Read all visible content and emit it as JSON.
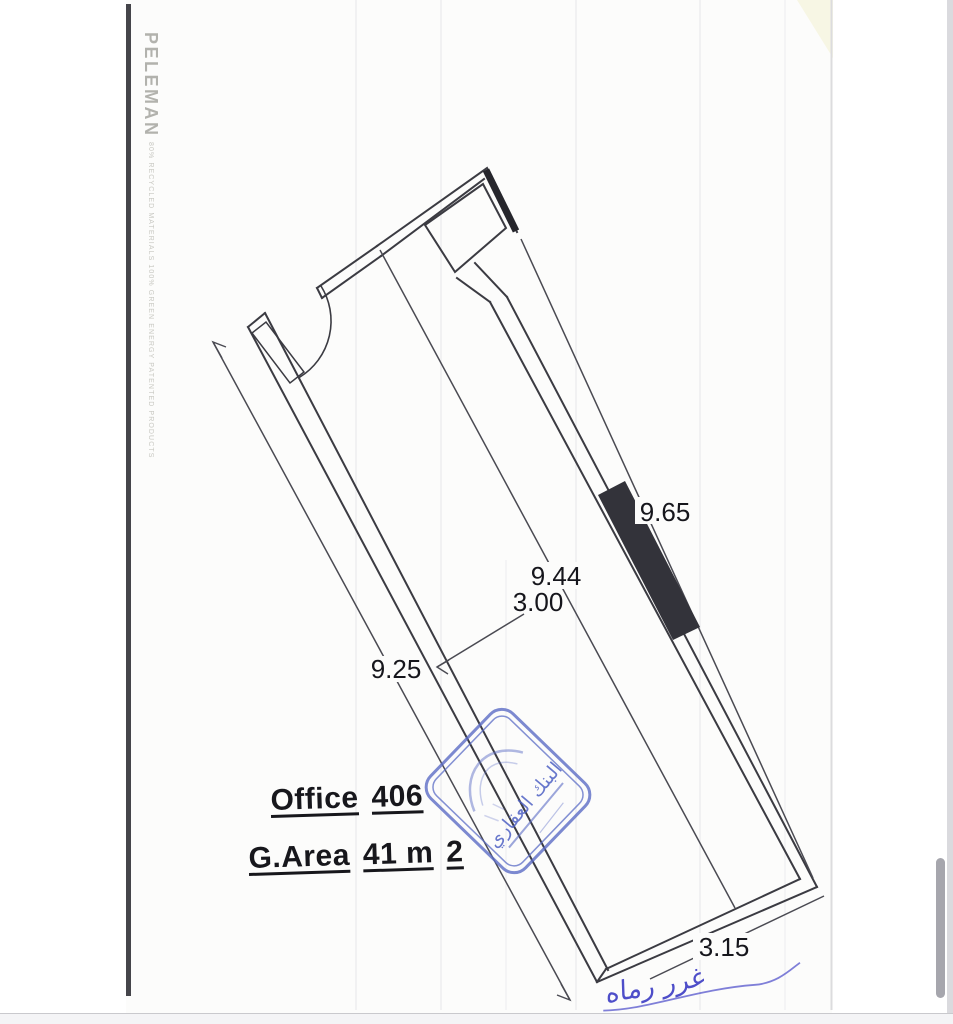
{
  "plan": {
    "title": {
      "word1": "Office",
      "word2": "406"
    },
    "area": {
      "word1": "G.Area",
      "word2": "41 m",
      "word3": "2"
    },
    "dims": {
      "right_wall": "9.65",
      "interior_length": "9.44",
      "width": "3.00",
      "left_wall": "9.25",
      "bottom": "3.15"
    }
  },
  "stamp": {
    "line1": "البنك العقاري"
  },
  "signature": {
    "text": "غرر رماه"
  },
  "binding_strip": {
    "brand": "PELEMAN",
    "tagline": "80% RECYCLED MATERIALS   100% GREEN ENERGY   PATENTED PRODUCTS"
  },
  "colors": {
    "wall_ink": "#3b3b42",
    "dim_ink": "#4a4a52",
    "dim_text": "#16161c",
    "shear_wall_fill": "#33333a",
    "stamp_blue": "#5b6cc5",
    "signature_blue": "#3c3cc4",
    "paper": "#fcfcfb",
    "spine": "#45454a"
  }
}
